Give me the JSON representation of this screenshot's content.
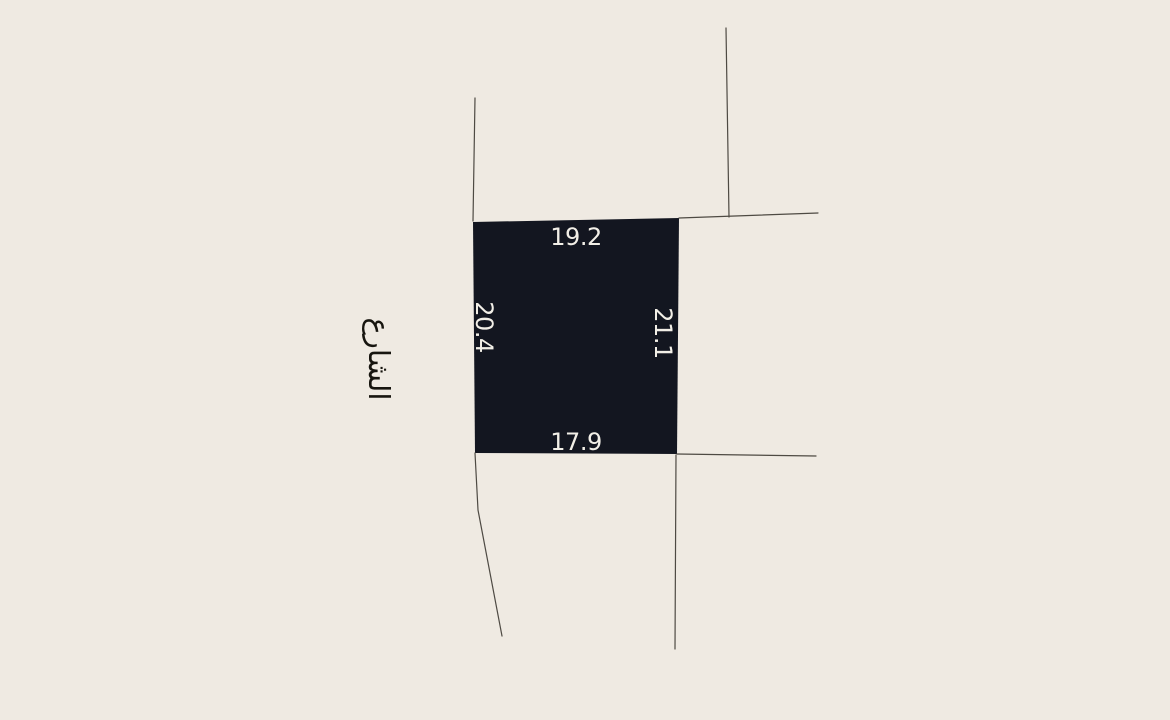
{
  "colors": {
    "background": "#efeae2",
    "plot-fill": "#131620",
    "plot-label": "#f2efe7",
    "street-label": "#17150f",
    "boundary-line": "#4e4a43"
  },
  "plot": {
    "dimensions": {
      "top": "19.2",
      "left": "20.4",
      "right": "21.1",
      "bottom": "17.9"
    }
  },
  "street": {
    "label": "الشارع"
  }
}
